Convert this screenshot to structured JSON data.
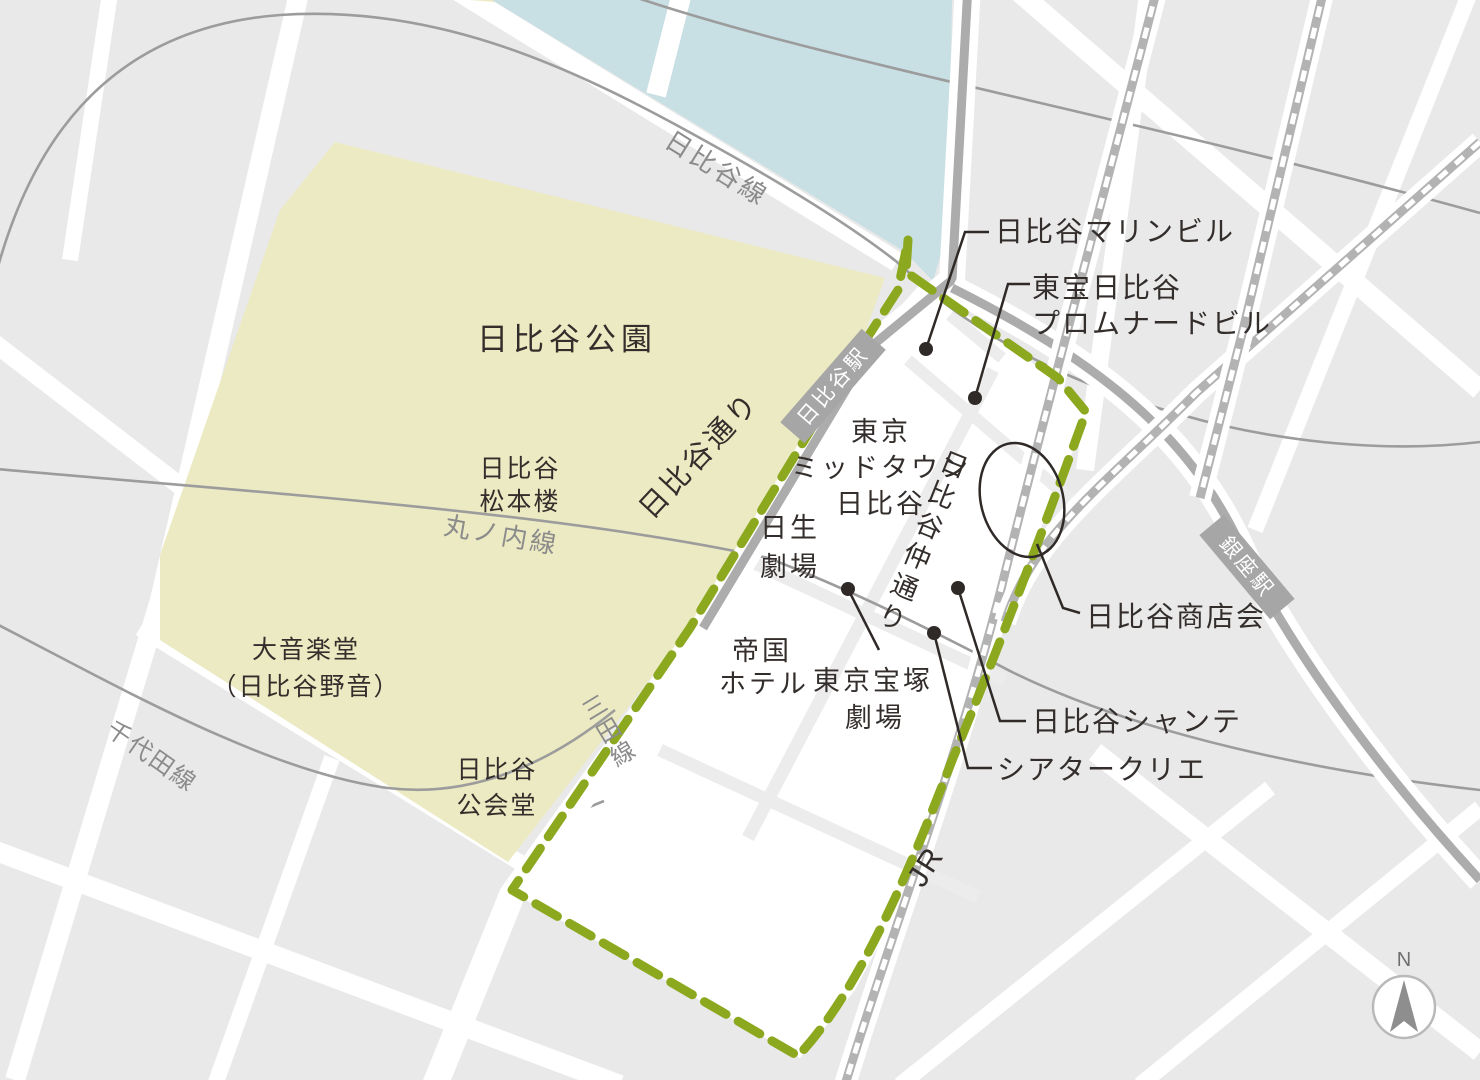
{
  "colors": {
    "block": "#e9e9e9",
    "street": "#ffffff",
    "park": "#eceac2",
    "water": "#c8dfe4",
    "road": "#acacac",
    "rail": "#b3b3b3",
    "subway_line": "#9c9c9c",
    "boundary_green": "#8ca81f",
    "ink": "#332e2b",
    "muted_gray": "#8b8b8b",
    "badge_gray": "#a6a6a6"
  },
  "places": {
    "park_title": "日比谷公園",
    "matsumotoro": [
      "日比谷",
      "松本楼"
    ],
    "ongakudo": [
      "大音楽堂",
      "（日比谷野音）"
    ],
    "kokaido": [
      "日比谷",
      "公会堂"
    ],
    "midtown": [
      "東京",
      "ミッドタウン",
      "日比谷"
    ],
    "nissay": [
      "日生",
      "劇場"
    ],
    "imperial": [
      "帝国",
      "ホテル"
    ],
    "takarazuka": [
      "東京宝塚",
      "劇場"
    ]
  },
  "callouts": {
    "marine": "日比谷マリンビル",
    "promenade": [
      "東宝日比谷",
      "プロムナードビル"
    ],
    "shotenkai": "日比谷商店会",
    "chanter": "日比谷シャンテ",
    "creation": "シアタークリエ"
  },
  "transit": {
    "hibiya_line": "日比谷線",
    "marunouchi_line": "丸ノ内線",
    "chiyoda_line": "千代田線",
    "mita_line": "三田線",
    "jr": "JR",
    "hibiya_station": "日比谷駅",
    "ginza_station": "銀座駅",
    "hibiya_dori": "日比谷通り",
    "naka_dori": "日比谷仲通り"
  },
  "compass": {
    "north": "N"
  }
}
